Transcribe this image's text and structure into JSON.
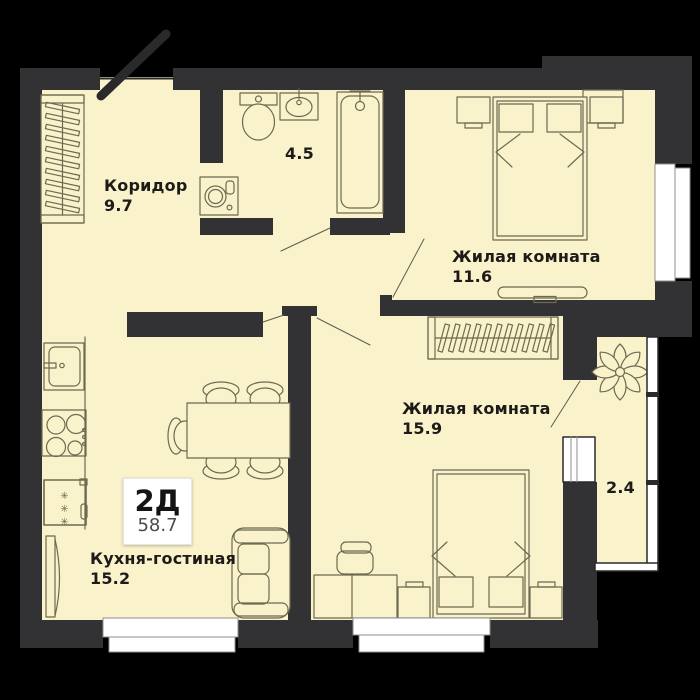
{
  "plan": {
    "unit": {
      "type_label": "2Д",
      "total_area": "58.7"
    },
    "rooms": [
      {
        "key": "corridor",
        "name": "Коридор",
        "area": "9.7"
      },
      {
        "key": "bathroom",
        "name": "",
        "area": "4.5"
      },
      {
        "key": "living-room-1",
        "name": "Жилая комната",
        "area": "11.6"
      },
      {
        "key": "living-room-2",
        "name": "Жилая комната",
        "area": "15.9"
      },
      {
        "key": "kitchen-living",
        "name": "Кухня-гостиная",
        "area": "15.2"
      },
      {
        "key": "balcony",
        "name": "",
        "area": "2.4"
      }
    ],
    "icons": {
      "snowflake_char": "✳"
    },
    "colors": {
      "background": "#000000",
      "wall": "#323134",
      "floor": "#faf2ca",
      "furniture_line": "#6c6a52",
      "window_white": "#ffffff",
      "label_text": "#1d1b19",
      "area_secondary": "#4b4b4b"
    }
  }
}
